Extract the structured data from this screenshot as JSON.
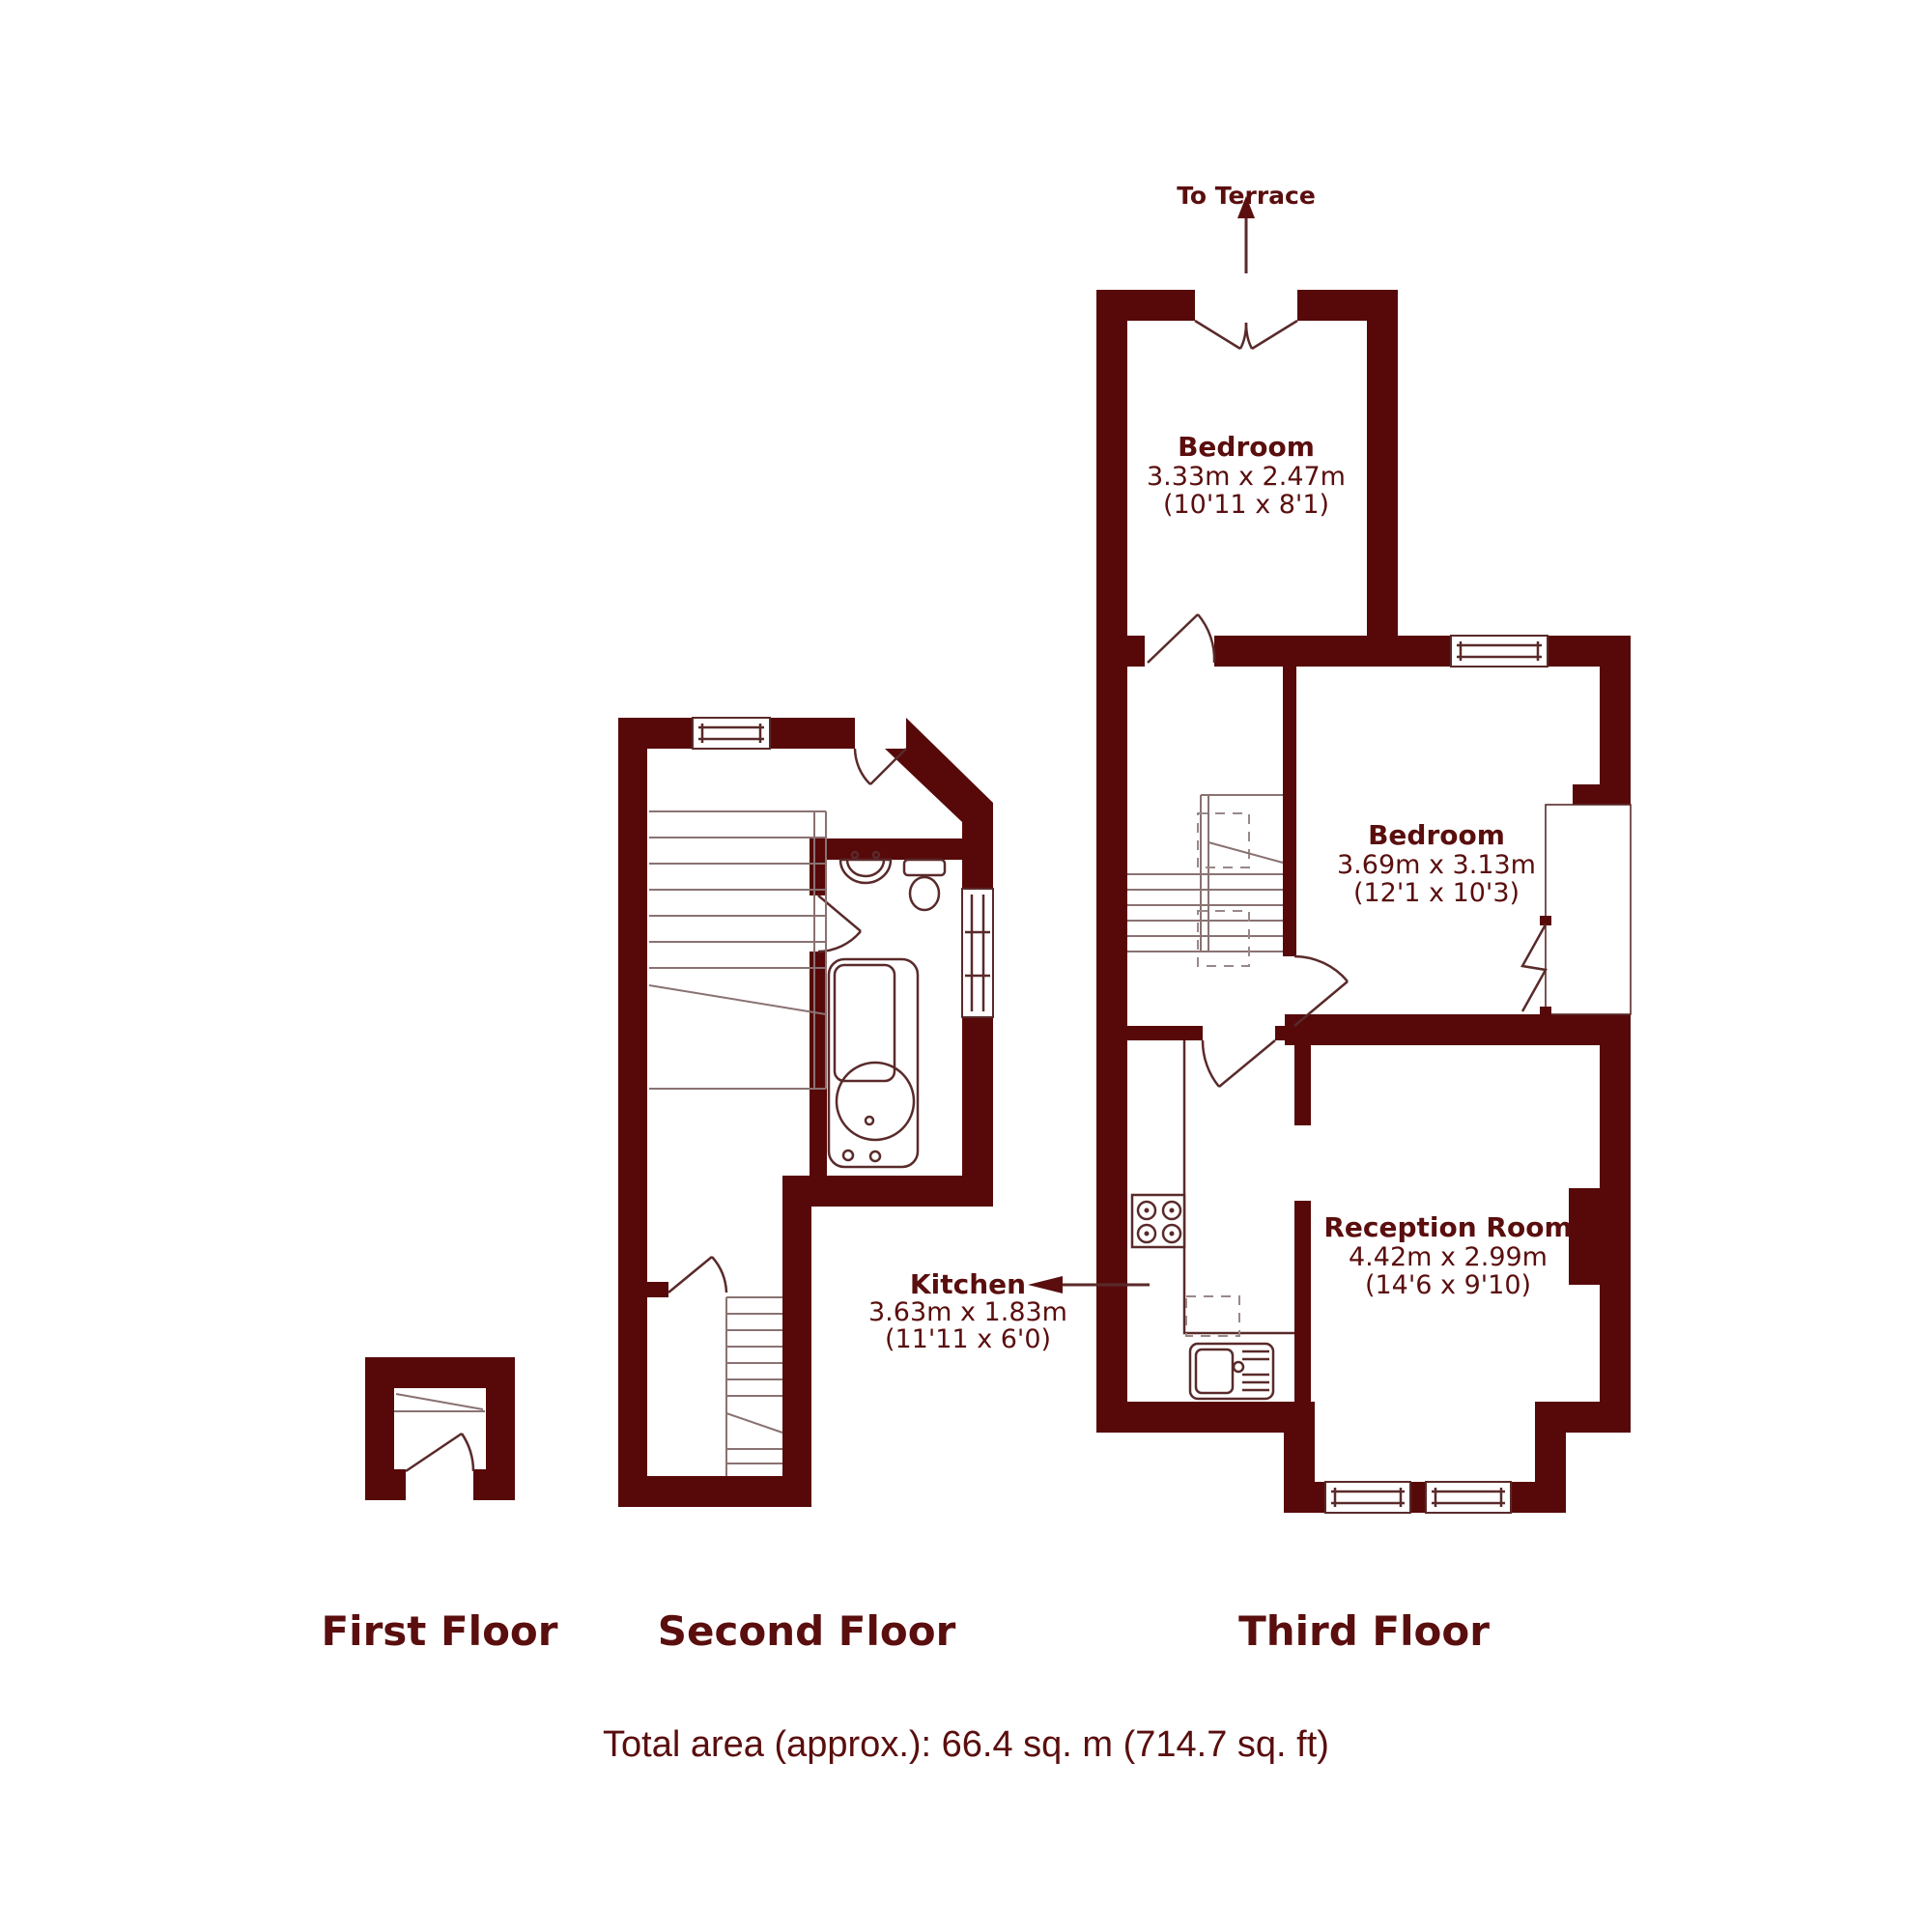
{
  "title": "Property floor plan",
  "colors": {
    "wall": "#570909",
    "text": "#5a0e0e",
    "fixture_line": "#5a2a2a",
    "background": "#ffffff"
  },
  "annotations": {
    "to_terrace": "To Terrace"
  },
  "floors": [
    {
      "name": "First Floor"
    },
    {
      "name": "Second Floor"
    },
    {
      "name": "Third Floor"
    }
  ],
  "rooms": [
    {
      "floor": "Third Floor",
      "name": "Bedroom",
      "metric": "3.33m x 2.47m",
      "imperial": "(10'11 x 8'1)"
    },
    {
      "floor": "Third Floor",
      "name": "Bedroom",
      "metric": "3.69m x 3.13m",
      "imperial": "(12'1 x 10'3)"
    },
    {
      "floor": "Third Floor",
      "name": "Reception Room",
      "metric": "4.42m x 2.99m",
      "imperial": "(14'6 x 9'10)"
    },
    {
      "floor": "Third Floor",
      "name": "Kitchen",
      "metric": "3.63m x 1.83m",
      "imperial": "(11'11 x 6'0)"
    }
  ],
  "footer": {
    "total_area": "Total area (approx.): 66.4 sq. m (714.7 sq. ft)"
  }
}
